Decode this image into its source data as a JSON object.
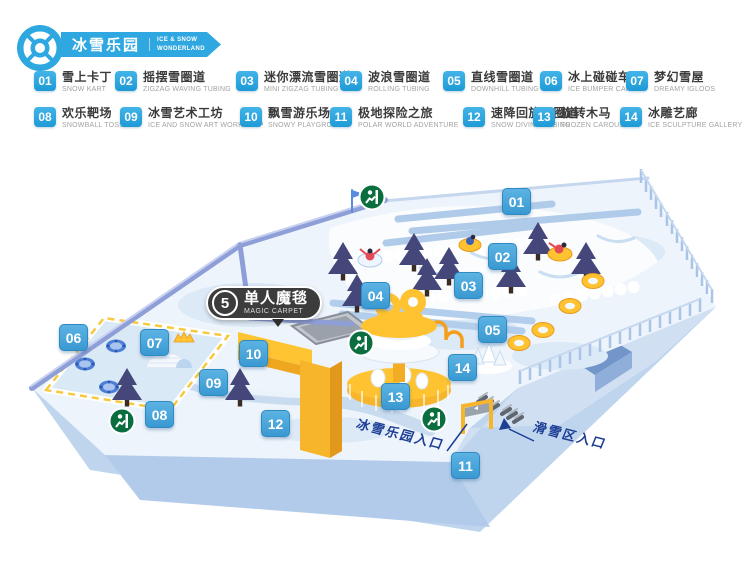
{
  "header": {
    "logo_icon": "life-ring",
    "title_zh": "冰雪乐园",
    "title_en_line1": "ICE & SNOW",
    "title_en_line2": "WONDERLAND",
    "banner_color": "#2FA7E0"
  },
  "legend": {
    "items": [
      {
        "num": "01",
        "zh": "雪上卡丁",
        "en": "SNOW KART"
      },
      {
        "num": "02",
        "zh": "摇摆雪圈道",
        "en": "ZIGZAG WAVING TUBING"
      },
      {
        "num": "03",
        "zh": "迷你漂流雪圈道",
        "en": "MINI ZIGZAG TUBING"
      },
      {
        "num": "04",
        "zh": "波浪雪圈道",
        "en": "ROLLING TUBING"
      },
      {
        "num": "05",
        "zh": "直线雪圈道",
        "en": "DOWNHILL TUBING"
      },
      {
        "num": "06",
        "zh": "冰上碰碰车",
        "en": "ICE BUMPER CARS"
      },
      {
        "num": "07",
        "zh": "梦幻雪屋",
        "en": "DREAMY IGLOOS"
      },
      {
        "num": "08",
        "zh": "欢乐靶场",
        "en": "SNOWBALL TOSS"
      },
      {
        "num": "09",
        "zh": "冰雪艺术工坊",
        "en": "ICE AND SNOW ART WORKSHOP"
      },
      {
        "num": "10",
        "zh": "飘雪游乐场",
        "en": "SNOWY PLAYGROUND"
      },
      {
        "num": "11",
        "zh": "极地探险之旅",
        "en": "POLAR WORLD ADVENTURE"
      },
      {
        "num": "12",
        "zh": "速降回旋雪圈道",
        "en": "SNOW DIVING TUBING"
      },
      {
        "num": "13",
        "zh": "旋转木马",
        "en": "FROZEN CAROUSEL"
      },
      {
        "num": "14",
        "zh": "冰雕艺廊",
        "en": "ICE SCULPTURE GALLERY"
      }
    ]
  },
  "map": {
    "magic_carpet": {
      "num": "5",
      "zh": "单人魔毯",
      "en": "MAGIC CARPET"
    },
    "entrance_labels": {
      "park": "冰雪乐园入口",
      "ski": "滑雪区入口"
    },
    "exit_icon": "emergency-exit",
    "colors": {
      "marker_blue": "#4AA7DB",
      "rim_purple": "#8E9ED6",
      "snow": "#EDF4FB",
      "yellow": "#FFC331",
      "exit_green": "#0B6E3F",
      "entrance_text": "#1D3E95",
      "tree": "#45477A",
      "base_blue": "#BFD5EE"
    }
  }
}
